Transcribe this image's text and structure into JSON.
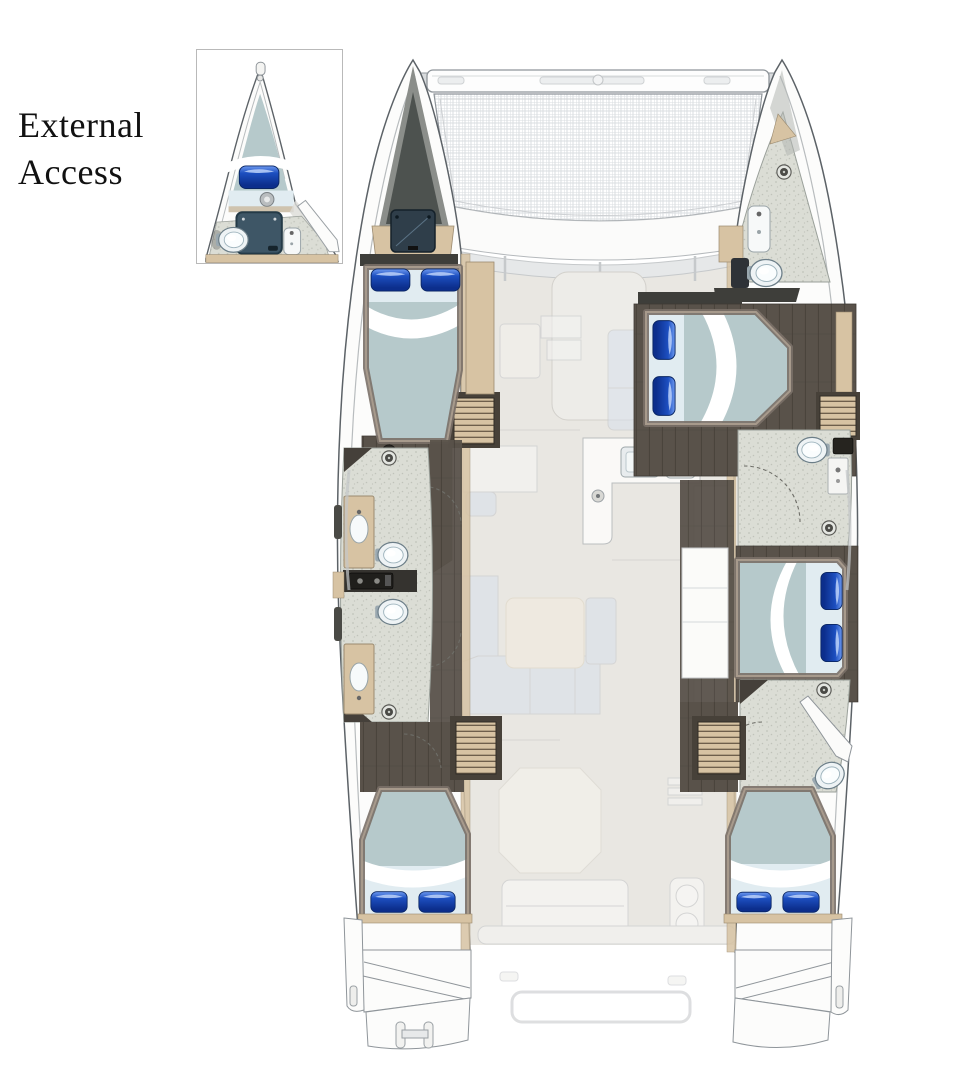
{
  "figure": {
    "label": "External\nAccess"
  },
  "palette": {
    "line": "#8f959a",
    "line_dark": "#5c6267",
    "hull": "#fcfcfb",
    "deck": "#e9e7e2",
    "mesh_line": "#dadde0",
    "floor_dark": "#59524a",
    "floor_line": "#48423b",
    "wood_light": "#d7c3a3",
    "wood_dark": "#9b8a6f",
    "bath_floor": "#dbddd5",
    "bath_speckle": "#c0c3ba",
    "wall_dark": "#3e3e3a",
    "mattress": "#b6c9cb",
    "mattress_light": "#e1ecf1",
    "pillow": "#1d4fc0",
    "pillow_dark": "#0c2e8c",
    "pillow_light": "#6e9af0",
    "hatch": "#2f3e4a",
    "ghost_line": "#c6c8ca",
    "ghost_blue": "#d9e1ec",
    "cream": "#f2ecdf",
    "porcelain": "#eef3f5",
    "text": "#111111",
    "inset_border": "#b9b9b9",
    "shower_panel": "#3e5666"
  }
}
